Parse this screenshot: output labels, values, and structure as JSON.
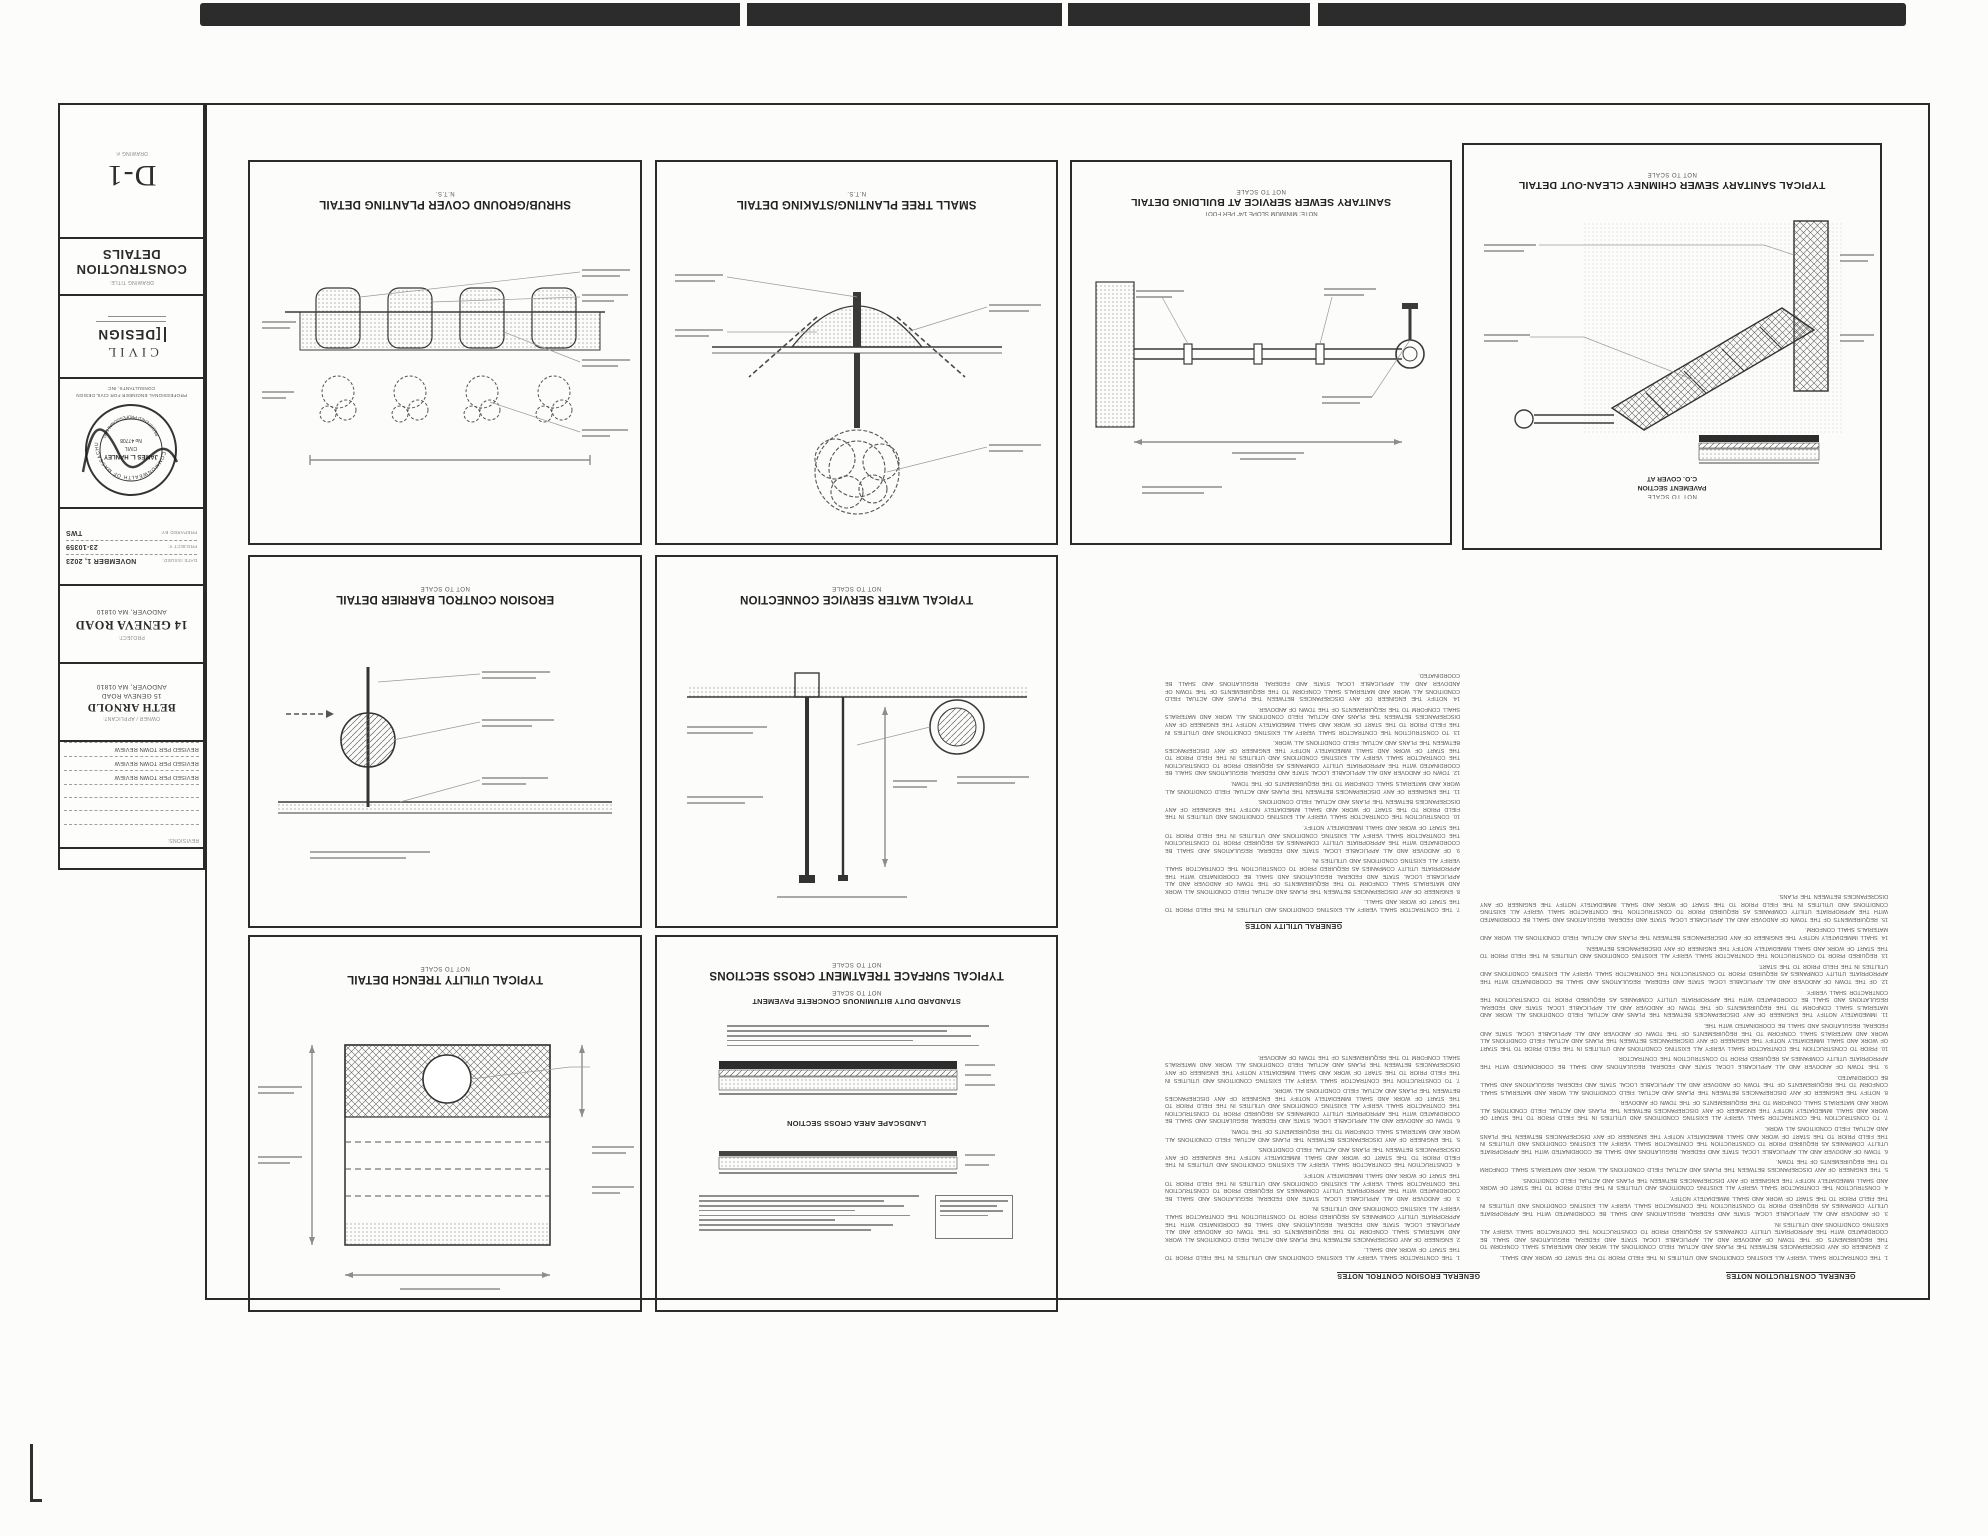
{
  "sheet": {
    "drawing_number_label": "DRAWING #:",
    "drawing_number": "D-1",
    "drawing_title_label": "DRAWING TITLE:",
    "drawing_title": "CONSTRUCTION DETAILS",
    "firm": {
      "logo_line1": "CIVIL",
      "logo_line2": "[DESIGN",
      "tagline_line1": "PROFESSIONAL ENGINEER FOR CIVIL DESIGN",
      "tagline_line2": "CONSULTANTS, INC"
    },
    "stamp": {
      "arc_top": "COMMONWEALTH OF MASSACHUSETTS",
      "name": "JAMES L. HANLEY",
      "discipline": "CIVIL",
      "license_no": "No 47708",
      "arc_bottom": "REGISTERED PROFESSIONAL ENGINEER"
    },
    "prepared_by_label": "PREPARED BY:",
    "prepared_by": "TWS",
    "project_no_label": "PROJECT #:",
    "project_no": "23-10359",
    "date_issued_label": "DATE ISSUED:",
    "date_issued": "NOVEMBER 1, 2023",
    "project_label": "PROJECT:",
    "project_name": "14 GENEVA ROAD",
    "project_address": "ANDOVER, MA 01810",
    "owner_label": "OWNER / APPLICANT:",
    "owner_name": "BETH ARNOLD",
    "owner_address1": "15 GENEVA ROAD",
    "owner_address2": "ANDOVER, MA 01810",
    "revisions_label": "REVISIONS:",
    "revisions": [
      "REVISED PER TOWN REVIEW",
      "REVISED PER TOWN REVIEW",
      "REVISED PER TOWN REVIEW"
    ]
  },
  "panels": {
    "shrub": {
      "title": "SHRUB/GROUND COVER PLANTING DETAIL",
      "scale": "N.T.S."
    },
    "tree": {
      "title": "SMALL TREE PLANTING/STAKING DETAIL",
      "scale": "N.T.S."
    },
    "sewer": {
      "title": "SANITARY SEWER SERVICE AT BUILDING DETAIL",
      "scale": "NOT TO SCALE",
      "note": "NOTE: MINIMUM SLOPE 1/4\" PER FOOT"
    },
    "cleanout": {
      "title": "TYPICAL SANITARY SEWER CHIMNEY CLEAN-OUT DETAIL",
      "scale": "NOT TO SCALE",
      "sub_line1": "C.O. COVER AT",
      "sub_line2": "PAVEMENT SECTION",
      "sub_scale": "NOT TO SCALE"
    },
    "erosion": {
      "title": "EROSION CONTROL BARRIER DETAIL",
      "scale": "NOT TO SCALE"
    },
    "water": {
      "title": "TYPICAL WATER SERVICE CONNECTION",
      "scale": "NOT TO SCALE"
    },
    "trench": {
      "title": "TYPICAL UTILITY TRENCH DETAIL",
      "scale": "NOT TO SCALE"
    },
    "surface": {
      "title": "TYPICAL SURFACE TREATMENT CROSS SECTIONS",
      "scale": "NOT TO SCALE",
      "sub1": "STANDARD DUTY BITUMINOUS CONCRETE PAVEMENT",
      "sub1_scale": "NOT TO SCALE",
      "sub2": "LANDSCAPE AREA CROSS SECTION"
    }
  },
  "notes": {
    "headers": {
      "construction": "GENERAL CONSTRUCTION NOTES",
      "erosion": "GENERAL EROSION CONTROL NOTES",
      "utility": "GENERAL UTILITY NOTES"
    },
    "illegible_filler": "THE CONTRACTOR SHALL VERIFY ALL EXISTING CONDITIONS AND UTILITIES IN THE FIELD PRIOR TO THE START OF WORK AND SHALL IMMEDIATELY NOTIFY THE ENGINEER OF ANY DISCREPANCIES BETWEEN THE PLANS AND ACTUAL FIELD CONDITIONS ALL WORK AND MATERIALS SHALL CONFORM TO THE REQUIREMENTS OF THE TOWN OF ANDOVER AND ALL APPLICABLE LOCAL STATE AND FEDERAL REGULATIONS AND SHALL BE COORDINATED WITH THE APPROPRIATE UTILITY COMPANIES AS REQUIRED PRIOR TO CONSTRUCTION"
  },
  "colors": {
    "line": "#2b2b2b",
    "paper": "#fcfcfb",
    "scanbar": "#2c2c2c",
    "microtext": "#8f8f8f"
  }
}
